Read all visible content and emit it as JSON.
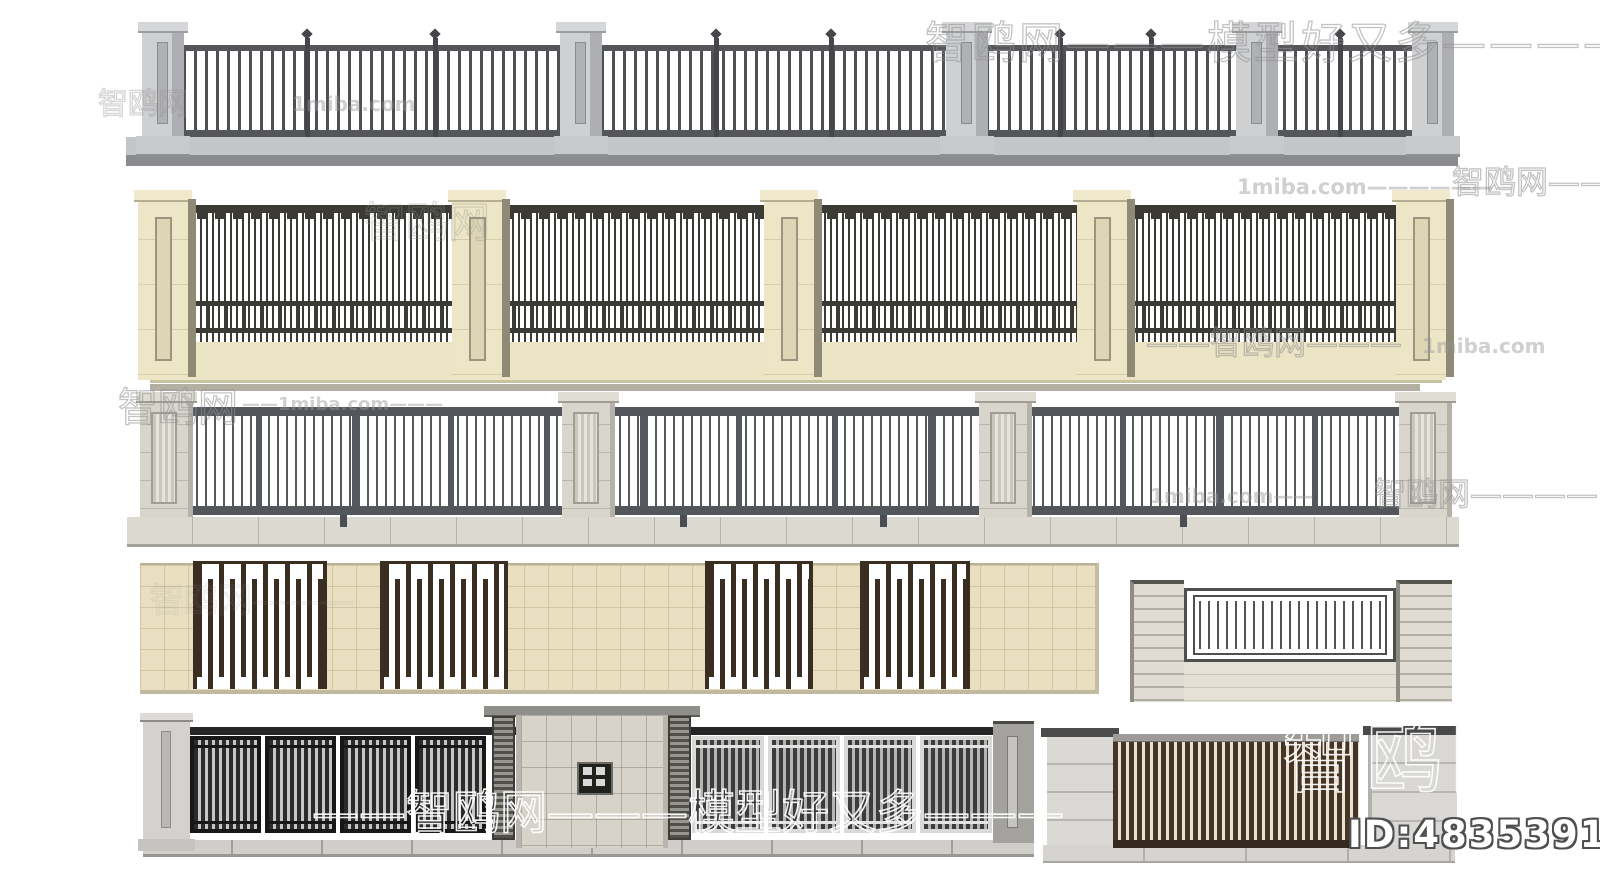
{
  "canvas": {
    "width": 1600,
    "height": 896,
    "background": "#ffffff"
  },
  "watermarks": {
    "items": [
      {
        "text": "智鸥网———模型好又多————"
      },
      {
        "text": "1miba.com"
      },
      {
        "text": "智鸥网"
      },
      {
        "text": "智鸥网"
      },
      {
        "text": "1miba.com——————"
      },
      {
        "text": "智鸥网——"
      },
      {
        "text": "——智鸥网———"
      },
      {
        "text": "1miba.com"
      },
      {
        "text": "智鸥网"
      },
      {
        "text": "——1miba.com———"
      },
      {
        "text": "1miba.com——"
      },
      {
        "text": "智鸥网————"
      },
      {
        "text": "智鸥网———"
      },
      {
        "text": "——智鸥网———模型好又多———"
      },
      {
        "text": "智鸥网"
      }
    ]
  },
  "id_overlay": {
    "label": "ID:483539197"
  },
  "palette": {
    "gray_metal": "#4e5054",
    "light_gray_pillar": "#c7c8ca",
    "cream_wall": "#ece5c5",
    "dark_iron": "#3b3a35",
    "stone_pillar": "#d8d5cc",
    "steel_fence": "#53565b",
    "sand_tile_wall": "#e9dfc0",
    "dark_brown_screen": "#3a2d21",
    "charcoal_panel": "#262626",
    "travertine_gate": "#d7d3cb",
    "marble_pillar": "#dad8d5",
    "walnut_slats": "#463527",
    "watermark_gray": "#919191",
    "watermark_white": "#ffffff"
  }
}
